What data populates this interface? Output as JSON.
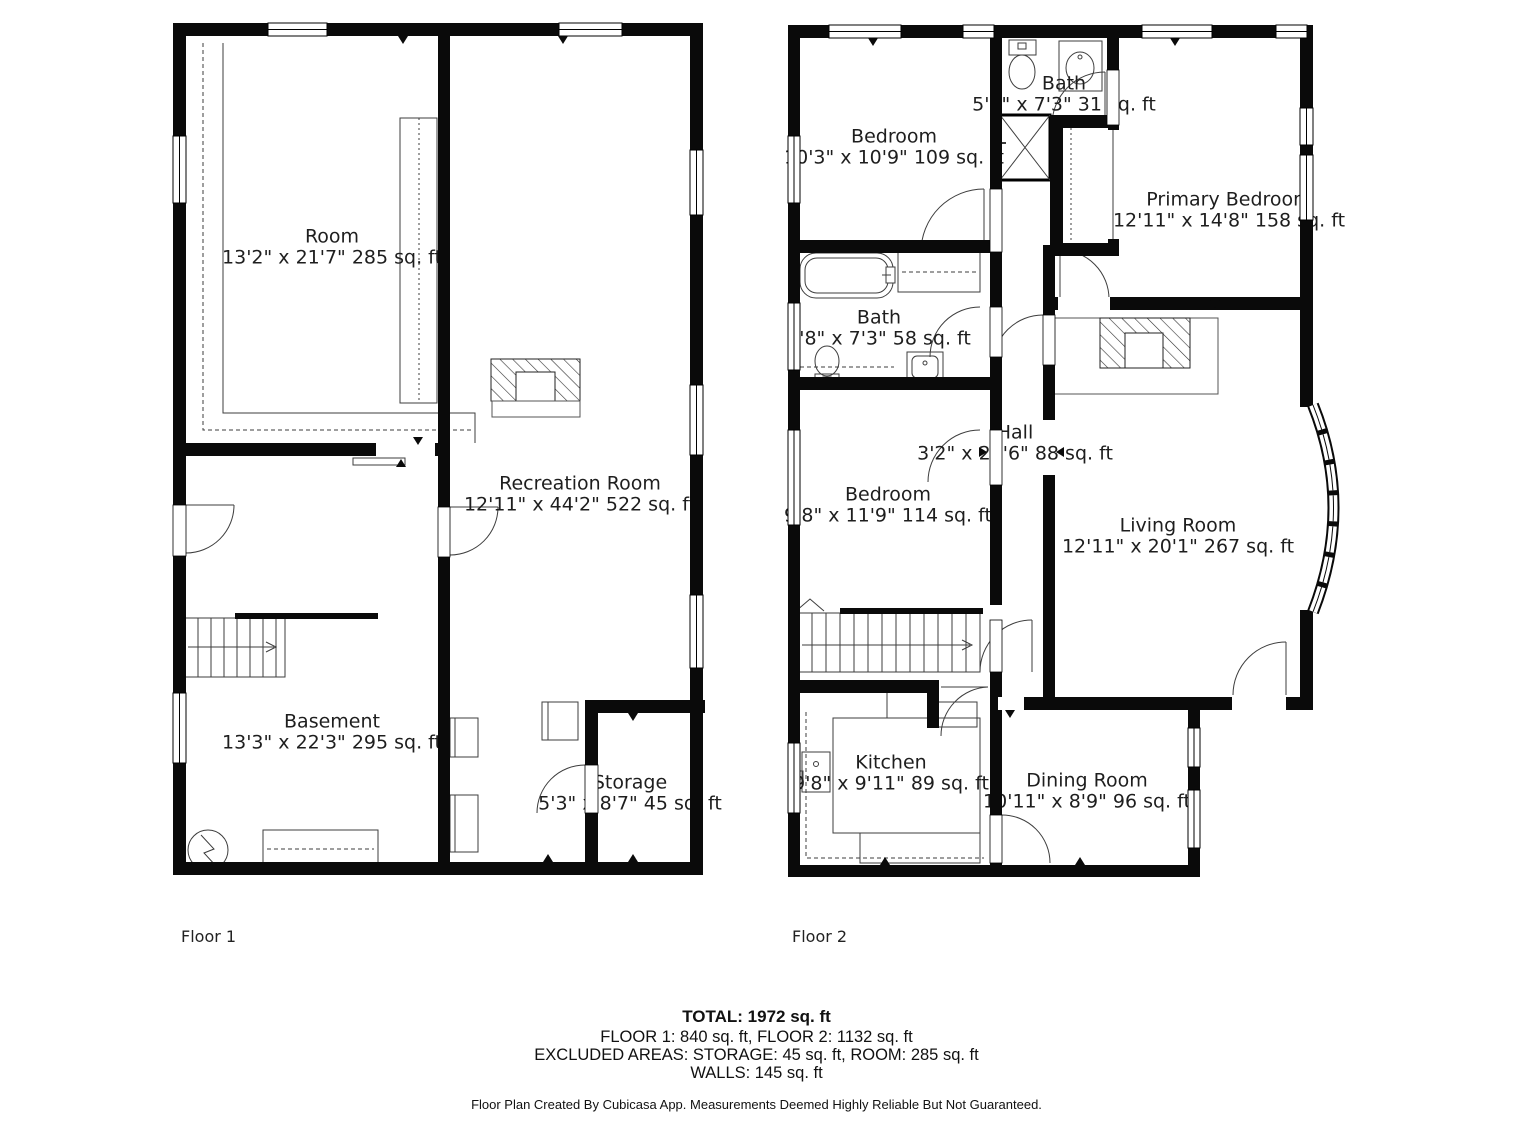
{
  "floor1": {
    "caption": "Floor 1",
    "rooms": {
      "room": {
        "name": "Room",
        "dims": "13'2\" x 21'7\" 285 sq. ft"
      },
      "recreation": {
        "name": "Recreation Room",
        "dims": "12'11\" x 44'2\" 522 sq. ft"
      },
      "basement": {
        "name": "Basement",
        "dims": "13'3\" x 22'3\" 295 sq. ft"
      },
      "storage": {
        "name": "Storage",
        "dims": "5'3\" x 8'7\" 45 sq. ft"
      }
    }
  },
  "floor2": {
    "caption": "Floor 2",
    "rooms": {
      "bedroom1": {
        "name": "Bedroom",
        "dims": "10'3\" x 10'9\" 109 sq. ft"
      },
      "bath1": {
        "name": "Bath",
        "dims": "5'1\" x 7'3\" 31 sq. ft"
      },
      "primary": {
        "name": "Primary Bedroom",
        "dims": "12'11\" x 14'8\" 158 sq. ft"
      },
      "bath2": {
        "name": "Bath",
        "dims": "9'8\" x 7'3\" 58 sq. ft"
      },
      "hall": {
        "name": "Hall",
        "dims": "3'2\" x 27'6\" 88 sq. ft"
      },
      "bedroom2": {
        "name": "Bedroom",
        "dims": "9'8\" x 11'9\" 114 sq. ft"
      },
      "living": {
        "name": "Living Room",
        "dims": "12'11\" x 20'1\" 267 sq. ft"
      },
      "kitchen": {
        "name": "Kitchen",
        "dims": "9'8\" x 9'11\" 89 sq. ft"
      },
      "dining": {
        "name": "Dining Room",
        "dims": "10'11\" x 8'9\" 96 sq. ft"
      }
    }
  },
  "summary": {
    "total": "TOTAL: 1972 sq. ft",
    "floors_line": "FLOOR 1: 840 sq. ft, FLOOR 2: 1132 sq. ft",
    "excluded_line": "EXCLUDED AREAS: STORAGE: 45 sq. ft, ROOM: 285 sq. ft",
    "walls_line": "WALLS: 145 sq. ft"
  },
  "footer": {
    "disclaimer": "Floor Plan Created By Cubicasa App. Measurements Deemed Highly Reliable But Not Guaranteed."
  },
  "colors": {
    "wall": "#0a0a0a",
    "fixture_line": "#3d3d3d",
    "text": "#1e1e1e"
  }
}
